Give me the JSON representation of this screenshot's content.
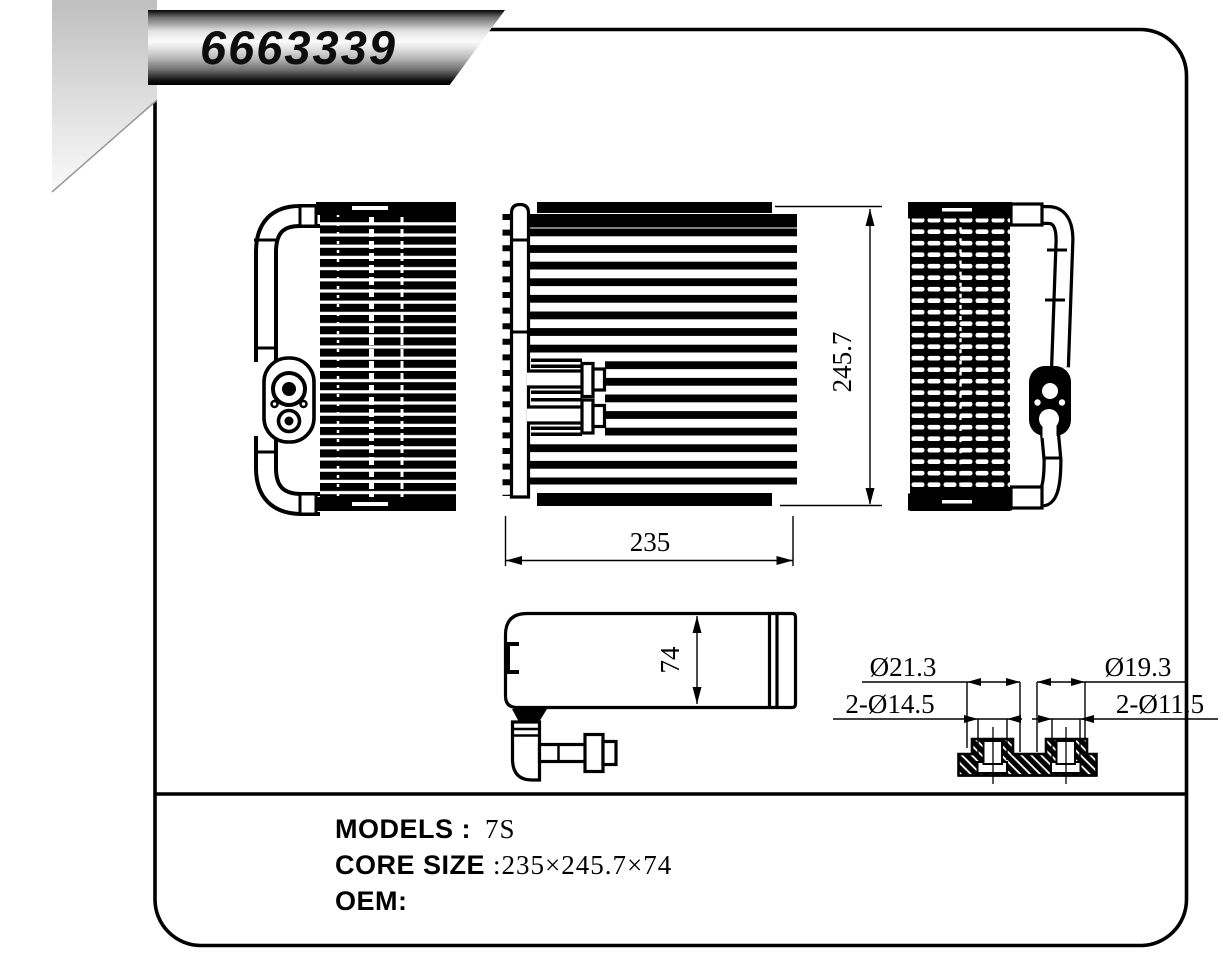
{
  "title_banner": {
    "part_number": "6663339"
  },
  "drawing": {
    "dim_width": "235",
    "dim_height": "245.7",
    "dim_depth": "74",
    "port_labels": {
      "outer_left": "Ø21.3",
      "outer_right": "Ø19.3",
      "holes_left": "2-Ø14.5",
      "holes_right": "2-Ø11.5"
    }
  },
  "spec_block": {
    "models_label": "MODELS :",
    "models_value": "7S",
    "core_size_label": "CORE SIZE",
    "core_size_value": ":235×245.7×74",
    "oem_label": "OEM:"
  },
  "colors": {
    "line": "#000000",
    "background": "#ffffff",
    "shade_top": "#c0c0c0",
    "shade_bottom": "#fafafa"
  }
}
